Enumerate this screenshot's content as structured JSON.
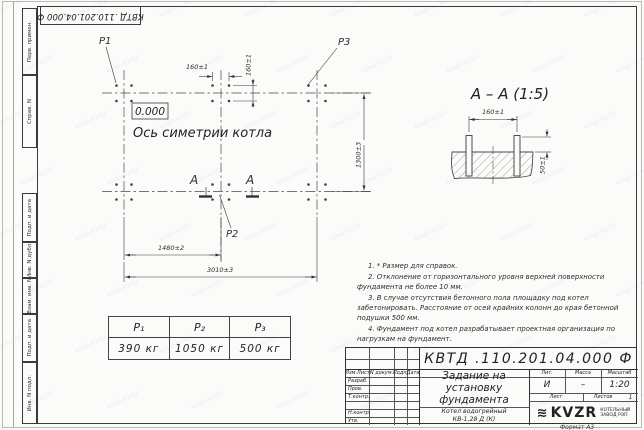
{
  "sheet": {
    "doc_number": "КВТД .110.201.04.000 Ф",
    "format_label": "Формат А3",
    "watermark": "kotel-kv.kz"
  },
  "margin": {
    "perv": "Перв. примен.",
    "sprav": "Справ. N",
    "podp1": "Подп. и дата",
    "inv_dubl": "Инв. N дубл.",
    "vzam": "Взам. инв. N",
    "podp2": "Подп. и дата",
    "inv_podl": "Инв. N подл."
  },
  "plan": {
    "level_mark": "0.000",
    "axis_label": "Ось симетрии котла",
    "p1": "P1",
    "p2": "P2",
    "p3": "P3",
    "section_letter": "А",
    "dims": {
      "d160h": "160±1",
      "d160v": "160±1",
      "d1300": "1300±3",
      "d1480": "1480±2",
      "d3010": "3010±3"
    }
  },
  "section": {
    "title": "А – А (1:5)",
    "dims": {
      "d160": "160±1",
      "d50": "50±1"
    }
  },
  "notes": [
    "1. * Размер для справок.",
    "2. Отклонение от горизонтального уровня верхней поверхности фундамента не более 10 мм.",
    "3. В случае отсутствия бетонного пола площадку под котел забетонировать. Расстояние от осей крайних колонн до края бетонной подушки 500 мм.",
    "4. Фундамент под котел разрабатывает проектная организация по нагрузкам на фундамент."
  ],
  "load_table": {
    "headers": [
      "P₁",
      "P₂",
      "P₃"
    ],
    "values": [
      "390 кг",
      "1050 кг",
      "500 кг"
    ]
  },
  "title_block": {
    "header_cols": [
      "Изм.Лист",
      "N докум.",
      "Подп.",
      "Дата"
    ],
    "rows": [
      "Разраб.",
      "Пров.",
      "Т.контр.",
      "",
      "Н.контр.",
      "Утв."
    ],
    "title_lines": [
      "Задание на",
      "установку",
      "фундамента"
    ],
    "product_lines": [
      "Котел водогрейный",
      "КВ-1,28 Д (К)"
    ],
    "lit_h": "Лит.",
    "mass_h": "Масса",
    "scale_h": "Масштаб",
    "lit": "И",
    "mass": "–",
    "scale": "1:20",
    "sheet_h": "Лист",
    "sheets_h": "Листов",
    "sheets_v": "1",
    "logo": "KVZR",
    "logo_sub1": "КОТЕЛЬНЫЙ",
    "logo_sub2": "ЗАВОД РЭП"
  }
}
